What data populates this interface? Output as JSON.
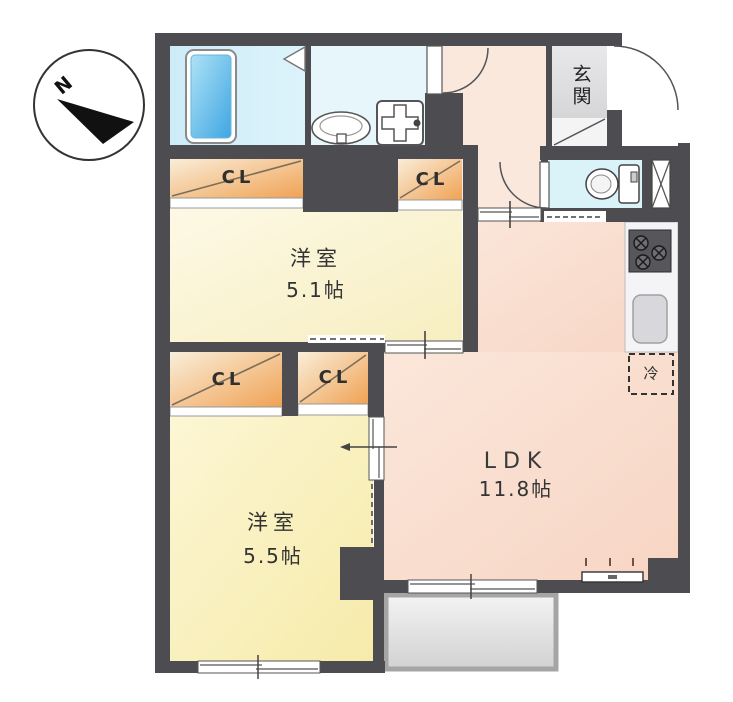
{
  "compass": {
    "north": "N"
  },
  "labels": {
    "entrance": "玄関",
    "refrigerator": "冷",
    "closets": [
      {
        "label": "CL"
      },
      {
        "label": "CL"
      },
      {
        "label": "CL"
      },
      {
        "label": "CL"
      }
    ]
  },
  "rooms": {
    "western_room_1": {
      "name": "洋室",
      "size": "5.1帖"
    },
    "western_room_2": {
      "name": "洋室",
      "size": "5.5帖"
    },
    "ldk": {
      "name": "LDK",
      "size": "11.8帖"
    }
  },
  "colors": {
    "wall": "#4d4d51",
    "room1_fill": "#fbf5da",
    "room2_fill": "#f9efb9",
    "ldk_fill": "#fae1d3",
    "closet_orange": "#f2aa5f",
    "bath_fill": "#d5effa",
    "washroom_fill": "#e6f6fb",
    "toilet_fill": "#d9f3f9",
    "entrance_tile": "#e2e2e4",
    "balcony_fill": "#e6e6e6",
    "bathtub_blue": "#53b4e8"
  }
}
